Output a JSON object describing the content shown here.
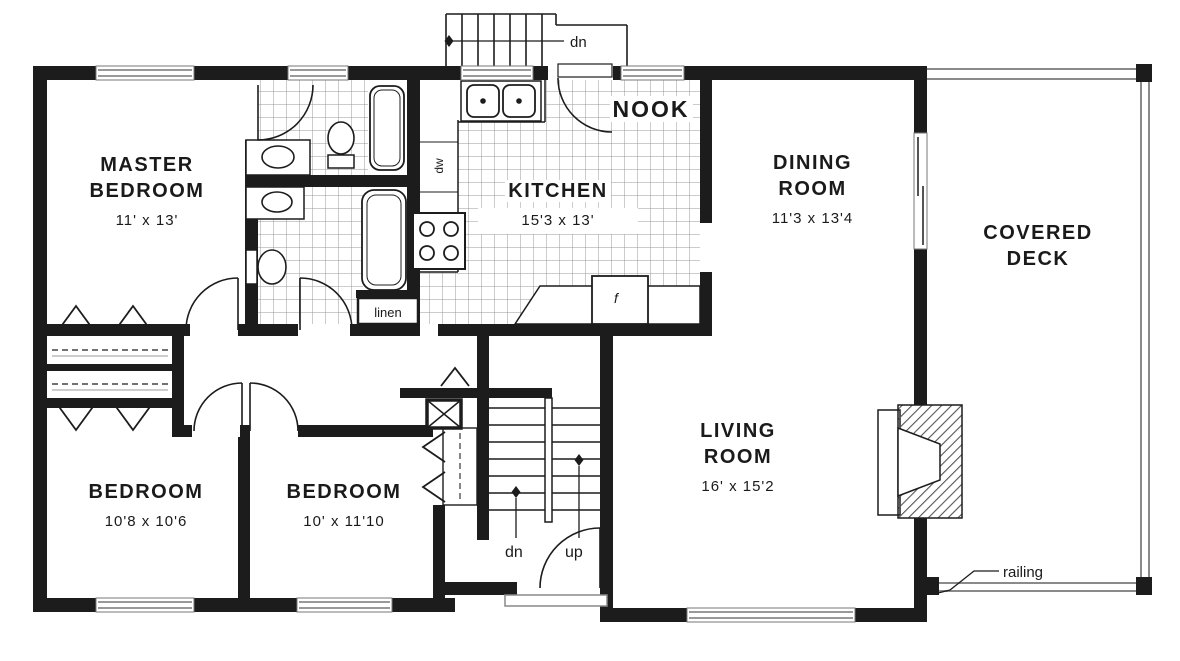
{
  "rooms": {
    "master": {
      "label": "MASTER BEDROOM",
      "size": "11' x 13'"
    },
    "kitchen": {
      "label": "KITCHEN",
      "size": "15'3 x 13'"
    },
    "nook": {
      "label": "NOOK"
    },
    "dining": {
      "label": "DINING ROOM",
      "size": "11'3 x 13'4"
    },
    "deck": {
      "label": "COVERED DECK"
    },
    "living": {
      "label": "LIVING ROOM",
      "size": "16' x 15'2"
    },
    "bedroom2": {
      "label": "BEDROOM",
      "size": "10'8 x 10'6"
    },
    "bedroom3": {
      "label": "BEDROOM",
      "size": "10' x 11'10"
    }
  },
  "annotations": {
    "stairs_down_exterior": "dn",
    "stairs_down": "dn",
    "stairs_up": "up",
    "dishwasher": "dw",
    "refrigerator": "f",
    "linen_closet": "linen",
    "deck_railing": "railing"
  },
  "colors": {
    "wall": "#1c1c1c",
    "tile_line": "#9a9a9a",
    "background": "#ffffff"
  }
}
